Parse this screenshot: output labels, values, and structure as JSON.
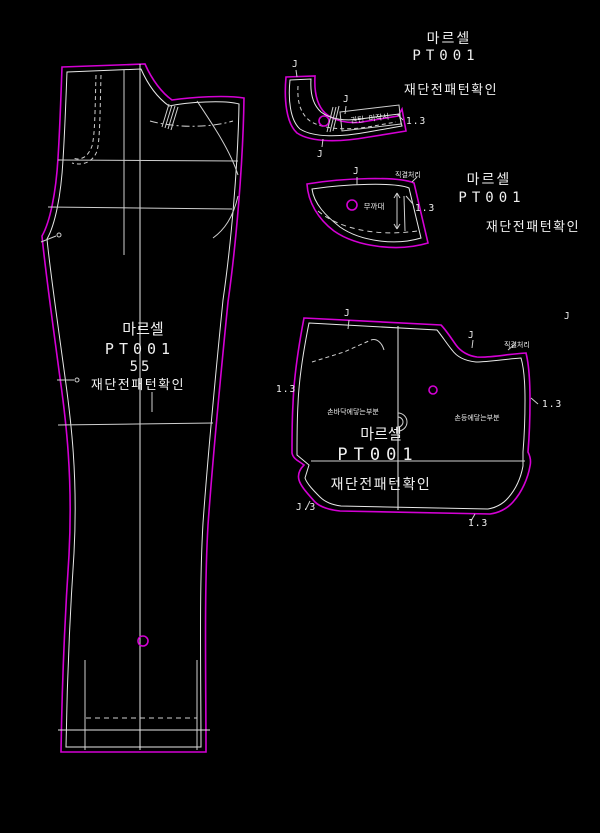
{
  "colors": {
    "background": "#000000",
    "outline_magenta": "#d400d4",
    "line_white": "#e8e8e8",
    "text_white": "#f0f0f0"
  },
  "header_block": {
    "title": "마르셀",
    "code": "PT001",
    "note": "재단전패턴확인"
  },
  "facing_block": {
    "title": "마르셀",
    "code": "PT001",
    "note": "재단전패턴확인"
  },
  "leg_piece": {
    "title": "마르셀",
    "code": "PT001",
    "size": "55",
    "note": "재단전패턴확인"
  },
  "pocket_piece": {
    "title": "마르셀",
    "code": "PT001",
    "note": "재단전패턴확인",
    "palm_label": "손바닥에닿는부분",
    "back_label": "손등에닿는부분"
  },
  "waistband_piece": {
    "box_label": "권틴 미작시"
  },
  "facing_piece": {
    "center_label": "무까대"
  },
  "labels": [
    {
      "text": "J"
    },
    {
      "text": "J"
    },
    {
      "text": "J"
    },
    {
      "text": "1.3"
    },
    {
      "text": "J"
    },
    {
      "text": "직결처리"
    },
    {
      "text": "1.3"
    },
    {
      "text": "J"
    },
    {
      "text": "J"
    },
    {
      "text": "직결처리"
    },
    {
      "text": "J"
    },
    {
      "text": "1.3"
    },
    {
      "text": "1.3"
    },
    {
      "text": "J.3"
    },
    {
      "text": "1.3"
    }
  ]
}
